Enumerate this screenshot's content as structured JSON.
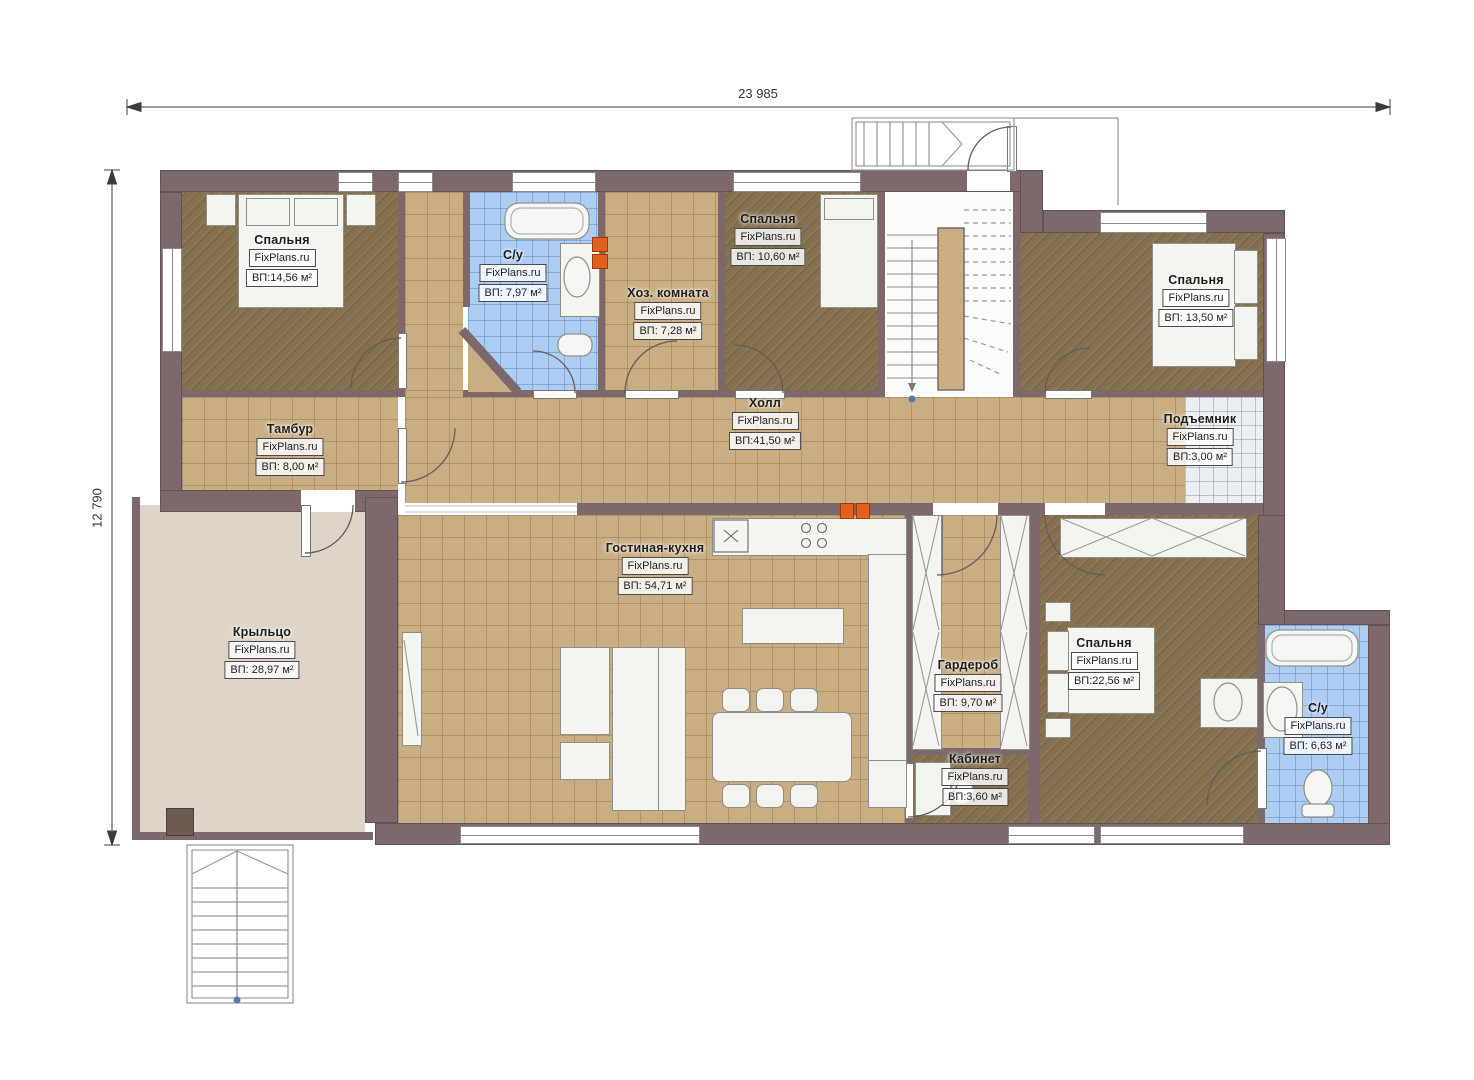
{
  "plan": {
    "kind": "floor-plan",
    "watermark": "FixPlans.ru"
  },
  "dimensions": {
    "width_label": "23 985",
    "height_label": "12 790"
  },
  "rooms": [
    {
      "id": "bedroom-1",
      "name": "Спальня",
      "brand": "FixPlans.ru",
      "area": "ВП:14,56 м²"
    },
    {
      "id": "bath-1",
      "name": "С/у",
      "brand": "FixPlans.ru",
      "area": "ВП: 7,97 м²"
    },
    {
      "id": "utility",
      "name": "Хоз. комната",
      "brand": "FixPlans.ru",
      "area": "ВП: 7,28 м²"
    },
    {
      "id": "bedroom-2",
      "name": "Спальня",
      "brand": "FixPlans.ru",
      "area": "ВП: 10,60 м²"
    },
    {
      "id": "bedroom-3",
      "name": "Спальня",
      "brand": "FixPlans.ru",
      "area": "ВП: 13,50 м²"
    },
    {
      "id": "tambour",
      "name": "Тамбур",
      "brand": "FixPlans.ru",
      "area": "ВП: 8,00 м²"
    },
    {
      "id": "hall",
      "name": "Холл",
      "brand": "FixPlans.ru",
      "area": "ВП:41,50 м²"
    },
    {
      "id": "lift",
      "name": "Подъемник",
      "brand": "FixPlans.ru",
      "area": "ВП:3,00 м²"
    },
    {
      "id": "porch",
      "name": "Крыльцо",
      "brand": "FixPlans.ru",
      "area": "ВП: 28,97 м²"
    },
    {
      "id": "living",
      "name": "Гостиная-кухня",
      "brand": "FixPlans.ru",
      "area": "ВП: 54,71 м²"
    },
    {
      "id": "wardrobe",
      "name": "Гардероб",
      "brand": "FixPlans.ru",
      "area": "ВП: 9,70 м²"
    },
    {
      "id": "bedroom-4",
      "name": "Спальня",
      "brand": "FixPlans.ru",
      "area": "ВП:22,56 м²"
    },
    {
      "id": "study",
      "name": "Кабинет",
      "brand": "FixPlans.ru",
      "area": "ВП:3,60 м²"
    },
    {
      "id": "bath-2",
      "name": "С/у",
      "brand": "FixPlans.ru",
      "area": "ВП: 6,63 м²"
    }
  ],
  "colors": {
    "wall": "#7d686c",
    "tan": "#c9ae83",
    "brown": "#857050",
    "blue": "#aecdf2",
    "porch": "#ded4c7",
    "accent": "#e2611c",
    "dim": "#333333"
  }
}
